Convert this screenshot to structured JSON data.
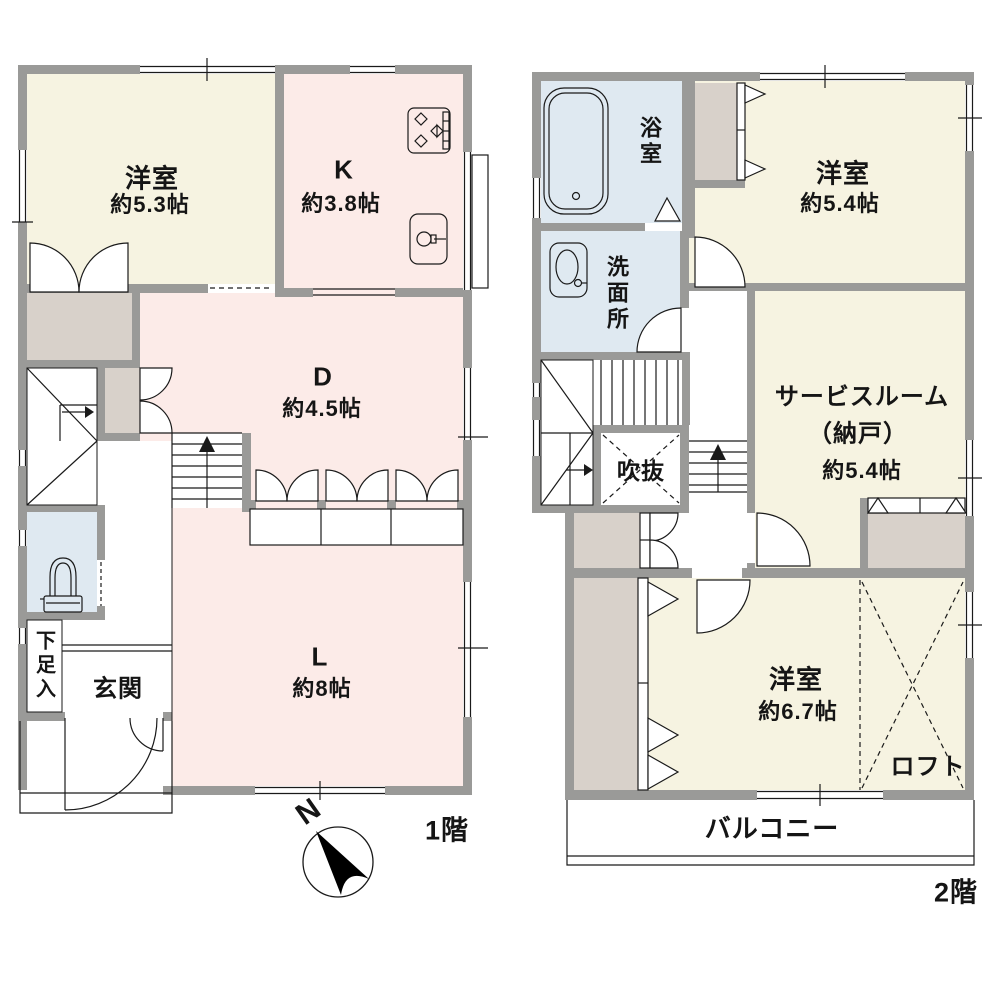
{
  "palette": {
    "wall": "#9a9a98",
    "line": "#1a1a1a",
    "western_room": "#f6f3e1",
    "ldk_room": "#fcebe8",
    "wet_room": "#dfe9f1",
    "closet": "#d8d1ca",
    "paper": "#ffffff"
  },
  "floor1": {
    "label": "1階",
    "compass": "N",
    "rooms": {
      "western": {
        "name": "洋室",
        "size": "約5.3帖"
      },
      "kitchen": {
        "name": "K",
        "size": "約3.8帖"
      },
      "dining": {
        "name": "D",
        "size": "約4.5帖"
      },
      "living": {
        "name": "L",
        "size": "約8帖"
      },
      "entrance": {
        "name": "玄関"
      },
      "shoe_storage": {
        "name": "下足入"
      }
    },
    "icons": [
      "stove-icon",
      "kitchen-sink-icon",
      "toilet-icon",
      "compass-north-icon",
      "stairs-up-arrow-icon"
    ]
  },
  "floor2": {
    "label": "2階",
    "rooms": {
      "bathroom": {
        "name": "浴室"
      },
      "washroom": {
        "name": "洗面所"
      },
      "western": {
        "name": "洋室",
        "size": "約5.4帖"
      },
      "service_room": {
        "name": "サービスルーム",
        "paren": "（納戸）",
        "size": "約5.4帖"
      },
      "void": {
        "name": "吹抜"
      },
      "western2": {
        "name": "洋室",
        "size": "約6.7帖"
      },
      "loft": {
        "name": "ロフト"
      },
      "balcony": {
        "name": "バルコニー"
      }
    },
    "icons": [
      "bathtub-icon",
      "washbasin-icon",
      "stairs-up-arrow-icon"
    ]
  }
}
